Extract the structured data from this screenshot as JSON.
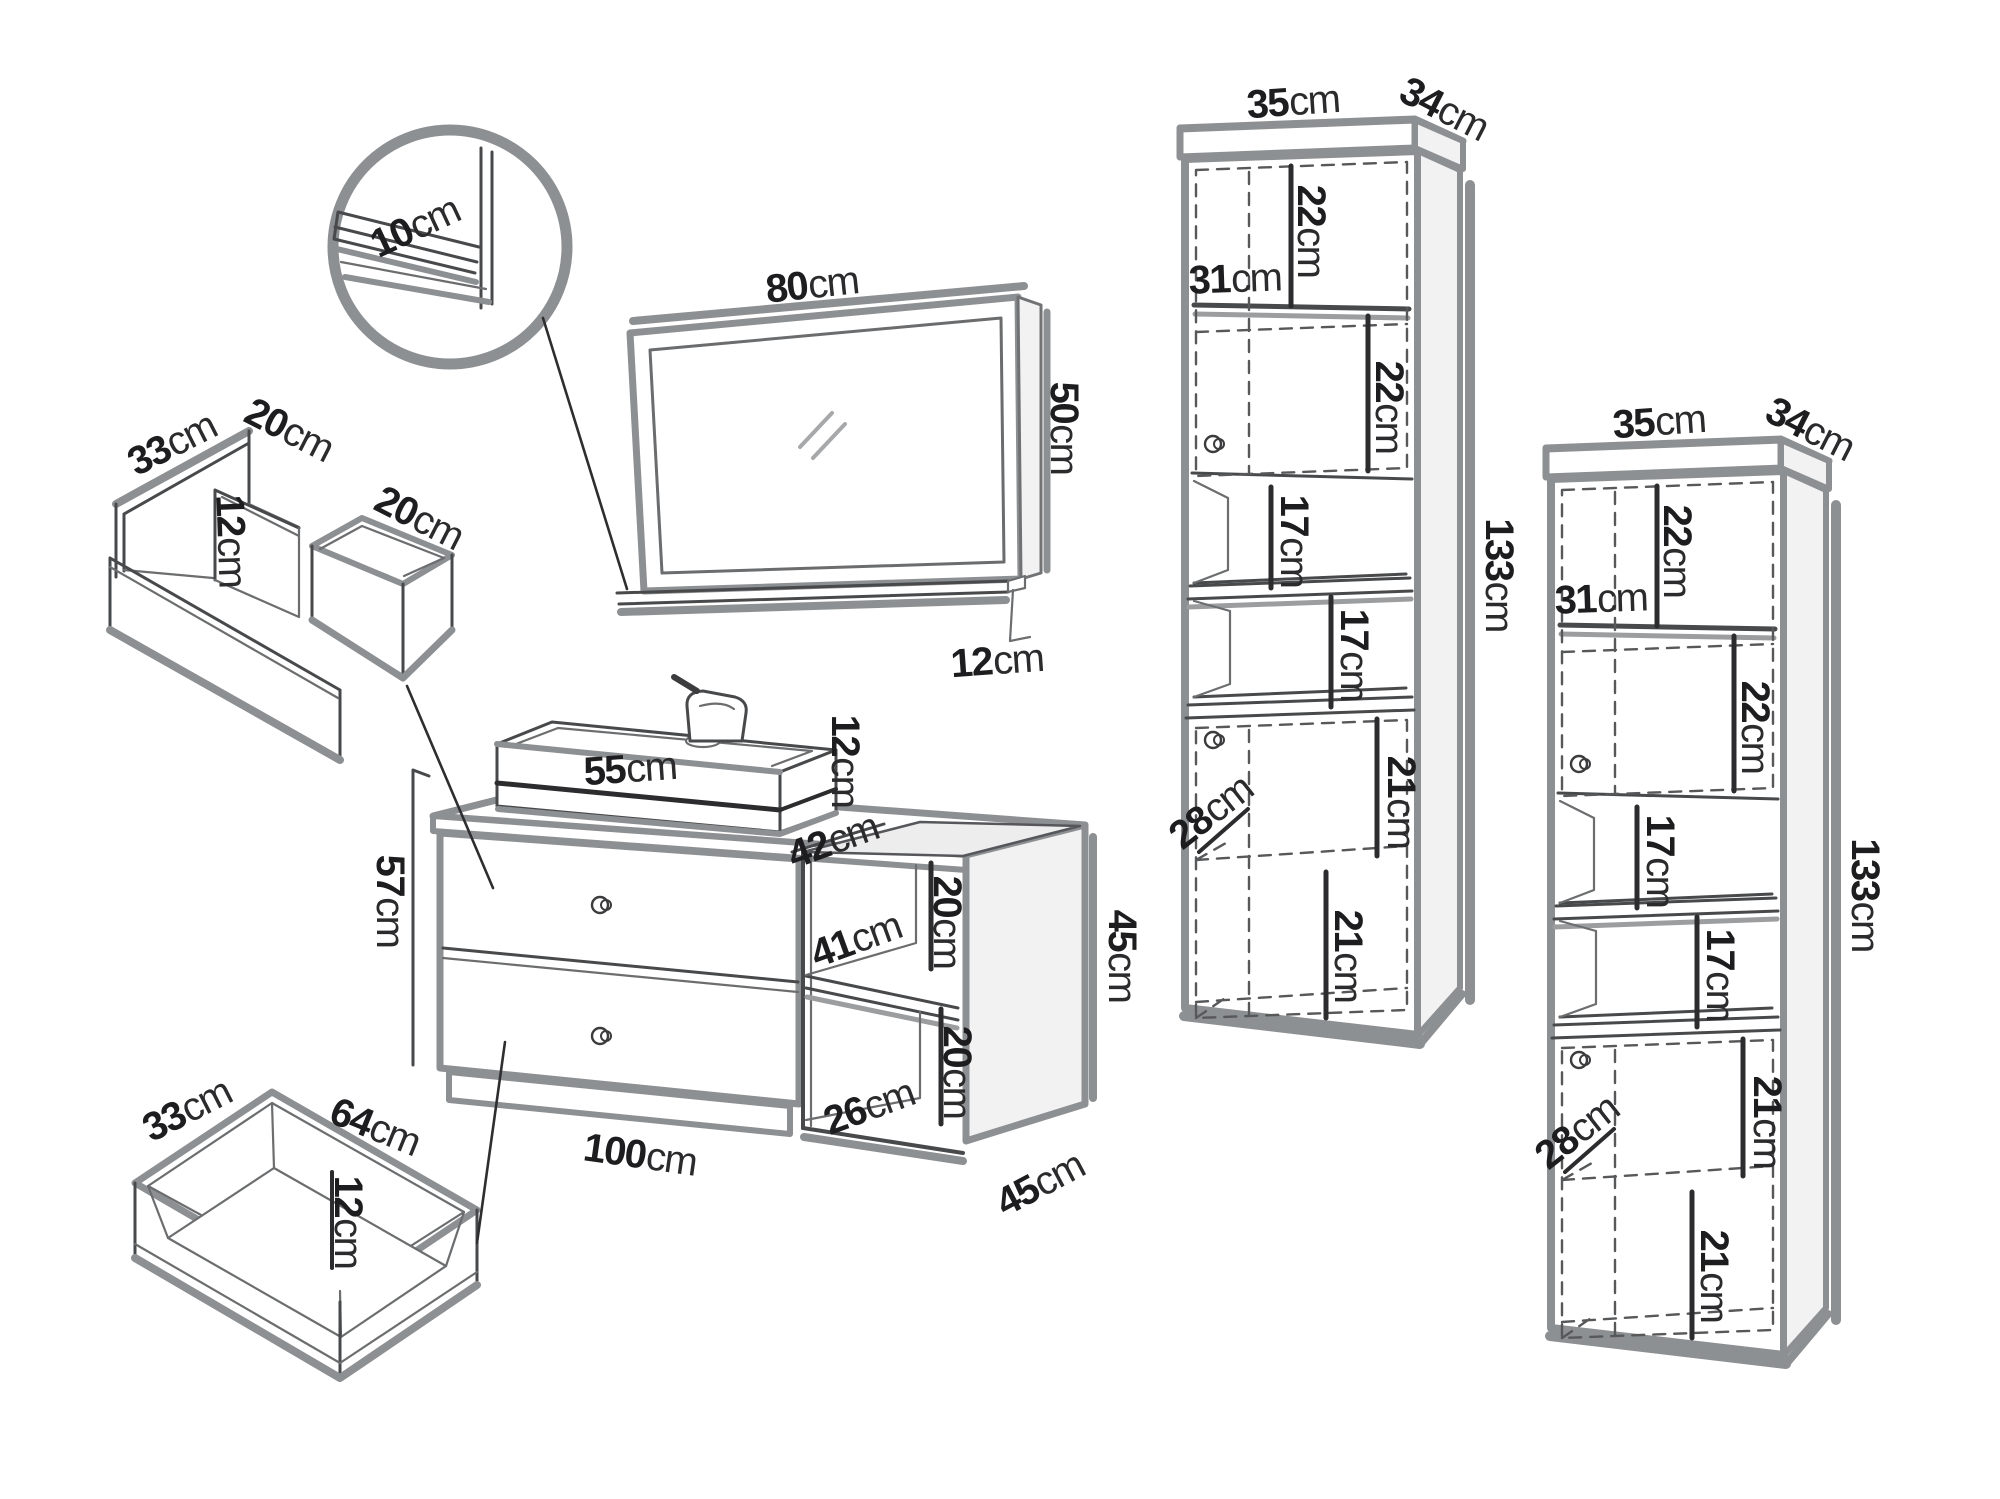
{
  "diagram": "bathroom-furniture-set-dimensions",
  "unit_suffix": "cm",
  "colors": {
    "outline": "#8d9092",
    "line": "#47494b",
    "dashed": "#57585a",
    "text": "#1d1d1f",
    "background": "#ffffff"
  },
  "figures": [
    {
      "name": "shelf-detail-circle",
      "labels": [
        {
          "v": "10",
          "u": "cm",
          "x": 415,
          "y": 227,
          "r": -25
        }
      ]
    },
    {
      "name": "mirror-with-shelf",
      "labels": [
        {
          "v": "80",
          "u": "cm",
          "x": 812,
          "y": 285,
          "r": -6
        },
        {
          "v": "50",
          "u": "cm",
          "x": 1064,
          "y": 428,
          "r": 90
        },
        {
          "v": "12",
          "u": "cm",
          "x": 997,
          "y": 661,
          "r": -4
        }
      ]
    },
    {
      "name": "top-drawer-detail",
      "labels": [
        {
          "v": "33",
          "u": "cm",
          "x": 172,
          "y": 444,
          "r": -27
        },
        {
          "v": "20",
          "u": "cm",
          "x": 289,
          "y": 430,
          "r": 27
        },
        {
          "v": "12",
          "u": "cm",
          "x": 231,
          "y": 541,
          "r": 88
        },
        {
          "v": "20",
          "u": "cm",
          "x": 419,
          "y": 518,
          "r": 27
        }
      ]
    },
    {
      "name": "vanity-unit-with-sink",
      "labels": [
        {
          "v": "55",
          "u": "cm",
          "x": 630,
          "y": 769,
          "r": -4
        },
        {
          "v": "12",
          "u": "cm",
          "x": 845,
          "y": 761,
          "r": 90
        },
        {
          "v": "42",
          "u": "cm",
          "x": 833,
          "y": 841,
          "r": -20
        },
        {
          "v": "57",
          "u": "cm",
          "x": 390,
          "y": 901,
          "r": 90
        },
        {
          "v": "41",
          "u": "cm",
          "x": 856,
          "y": 940,
          "r": -20
        },
        {
          "v": "20",
          "u": "cm",
          "x": 947,
          "y": 922,
          "r": 90
        },
        {
          "v": "20",
          "u": "cm",
          "x": 957,
          "y": 1072,
          "r": 90
        },
        {
          "v": "26",
          "u": "cm",
          "x": 869,
          "y": 1107,
          "r": -20
        },
        {
          "v": "45",
          "u": "cm",
          "x": 1122,
          "y": 956,
          "r": 90
        },
        {
          "v": "100",
          "u": "cm",
          "x": 640,
          "y": 1155,
          "r": 8
        },
        {
          "v": "45",
          "u": "cm",
          "x": 1040,
          "y": 1184,
          "r": -28
        }
      ]
    },
    {
      "name": "bottom-drawer-detail",
      "labels": [
        {
          "v": "33",
          "u": "cm",
          "x": 187,
          "y": 1110,
          "r": -27
        },
        {
          "v": "64",
          "u": "cm",
          "x": 375,
          "y": 1127,
          "r": 22
        },
        {
          "v": "12",
          "u": "cm",
          "x": 348,
          "y": 1222,
          "r": 90
        }
      ]
    },
    {
      "name": "tall-cabinet-1",
      "labels": [
        {
          "v": "35",
          "u": "cm",
          "x": 1293,
          "y": 102,
          "r": -4
        },
        {
          "v": "34",
          "u": "cm",
          "x": 1444,
          "y": 109,
          "r": 27
        },
        {
          "v": "22",
          "u": "cm",
          "x": 1311,
          "y": 231,
          "r": 90
        },
        {
          "v": "31",
          "u": "cm",
          "x": 1235,
          "y": 279,
          "r": -2
        },
        {
          "v": "22",
          "u": "cm",
          "x": 1389,
          "y": 407,
          "r": 90
        },
        {
          "v": "17",
          "u": "cm",
          "x": 1294,
          "y": 541,
          "r": 90
        },
        {
          "v": "17",
          "u": "cm",
          "x": 1354,
          "y": 655,
          "r": 90
        },
        {
          "v": "133",
          "u": "cm",
          "x": 1499,
          "y": 575,
          "r": 90
        },
        {
          "v": "21",
          "u": "cm",
          "x": 1401,
          "y": 802,
          "r": 90
        },
        {
          "v": "28",
          "u": "cm",
          "x": 1211,
          "y": 812,
          "r": -38
        },
        {
          "v": "21",
          "u": "cm",
          "x": 1348,
          "y": 956,
          "r": 90
        }
      ]
    },
    {
      "name": "tall-cabinet-2",
      "labels": [
        {
          "v": "35",
          "u": "cm",
          "x": 1659,
          "y": 422,
          "r": -4
        },
        {
          "v": "34",
          "u": "cm",
          "x": 1810,
          "y": 429,
          "r": 27
        },
        {
          "v": "22",
          "u": "cm",
          "x": 1677,
          "y": 551,
          "r": 90
        },
        {
          "v": "31",
          "u": "cm",
          "x": 1601,
          "y": 599,
          "r": -2
        },
        {
          "v": "22",
          "u": "cm",
          "x": 1755,
          "y": 727,
          "r": 90
        },
        {
          "v": "17",
          "u": "cm",
          "x": 1660,
          "y": 861,
          "r": 90
        },
        {
          "v": "17",
          "u": "cm",
          "x": 1720,
          "y": 975,
          "r": 90
        },
        {
          "v": "133",
          "u": "cm",
          "x": 1865,
          "y": 895,
          "r": 90
        },
        {
          "v": "21",
          "u": "cm",
          "x": 1767,
          "y": 1122,
          "r": 90
        },
        {
          "v": "28",
          "u": "cm",
          "x": 1577,
          "y": 1132,
          "r": -38
        },
        {
          "v": "21",
          "u": "cm",
          "x": 1714,
          "y": 1276,
          "r": 90
        }
      ]
    }
  ]
}
